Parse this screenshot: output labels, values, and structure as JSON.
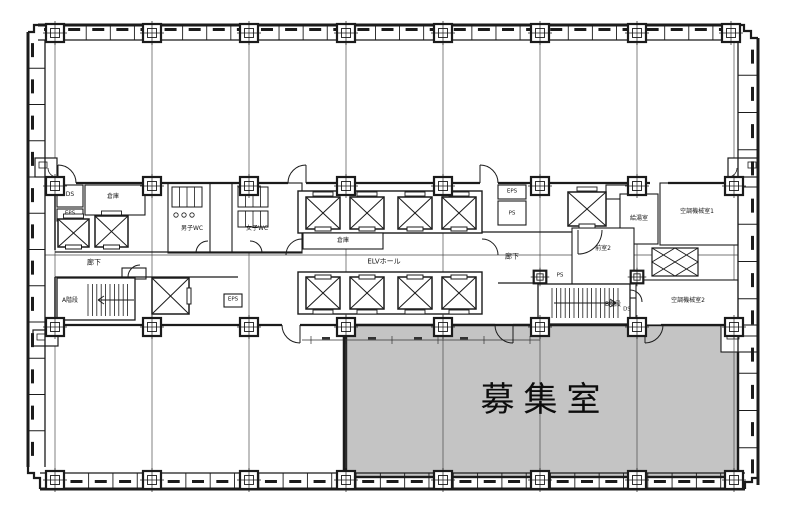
{
  "plan": {
    "highlight_color": "#c4c4c4",
    "ink_color": "#1b1b1b",
    "labels": {
      "vacant_room": "募集室",
      "elv_hall": "ELVホール",
      "corridor_left": "廊下",
      "corridor_right": "廊下",
      "stair_a": "A階段",
      "stair_b": "B階段",
      "anteroom_2": "前室2",
      "storage_center": "倉庫",
      "storage_left": "倉庫",
      "ds_left": "DS",
      "eps_left": "EPS",
      "eps_lower": "EPS",
      "wc_male": "男子WC",
      "wc_female": "女子WC",
      "eps_right": "EPS",
      "ps_right": "PS",
      "ps_stair_b": "PS",
      "hot_water_room": "給湯室",
      "ac_machine_room_1": "空調機械室1",
      "ac_machine_room_2": "空調機械室2",
      "ds_right": "DS"
    }
  }
}
